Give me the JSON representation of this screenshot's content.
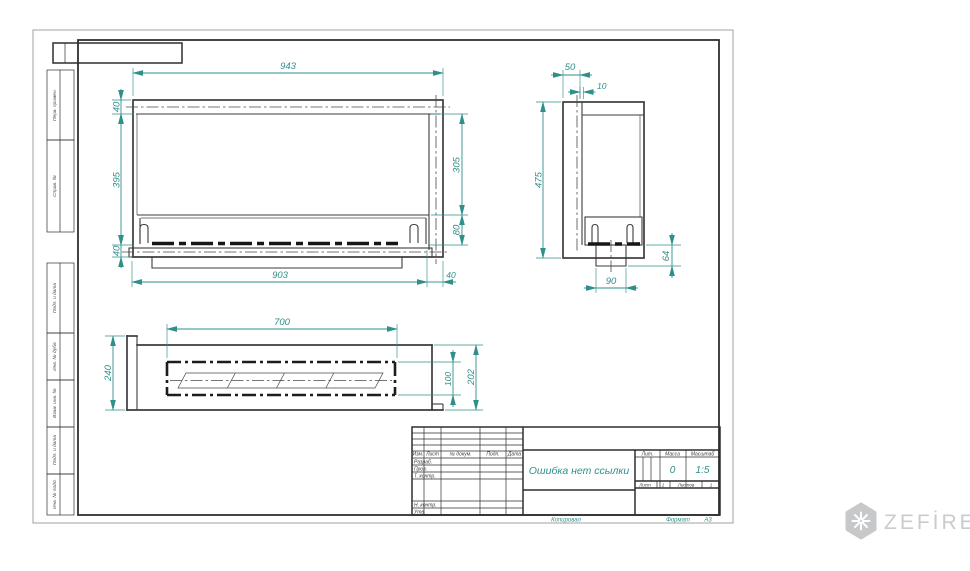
{
  "sheet": {
    "left_margin_labels": [
      "Перв. примен.",
      "Справ. №",
      "Подп. и дата",
      "Инв. № дубл.",
      "Взам. инв. №",
      "Подп. и дата",
      "Инв. № подл."
    ],
    "footer": {
      "copied": "Копировал",
      "format_label": "Формат",
      "format_value": "А3"
    }
  },
  "views": {
    "front": {
      "dim_total_width": "943",
      "dim_top_band": "40",
      "dim_glass_height": "395",
      "dim_bottom_band": "40",
      "dim_opening_height": "305",
      "dim_burner_depth": "80",
      "dim_inner_width": "903",
      "dim_right_band": "40"
    },
    "side": {
      "dim_depth": "50",
      "dim_wall": "10",
      "dim_height": "475",
      "dim_base_width": "90",
      "dim_base_height": "64"
    },
    "plan": {
      "dim_slot_length": "700",
      "dim_depth": "240",
      "dim_slot_width": "100",
      "dim_inner_depth": "202"
    }
  },
  "title_block": {
    "change_cols": {
      "izm": "Изм.",
      "list": "Лист",
      "doc": "№ докум.",
      "sign": "Подп.",
      "date": "Дата"
    },
    "roles": {
      "developed": "Разраб.",
      "checked": "Пров.",
      "tcontrol": "Т. контр.",
      "ncontrol": "Н. контр.",
      "approved": "Утв."
    },
    "doc_title": "Ошибка нет ссылки",
    "lit_label": "Лит.",
    "mass_label": "Масса",
    "scale_label": "Масштаб",
    "mass_value": "0",
    "scale_value": "1:5",
    "sheet_label": "Лист",
    "sheet_value": "1",
    "sheets_label": "Листов",
    "sheets_value": "1"
  },
  "logo": {
    "brand": "ZEFİRE"
  },
  "colors": {
    "dimension": "#2F8F8A",
    "object_line": "#3c3c3c",
    "logo_gray": "#c9cbcd"
  }
}
